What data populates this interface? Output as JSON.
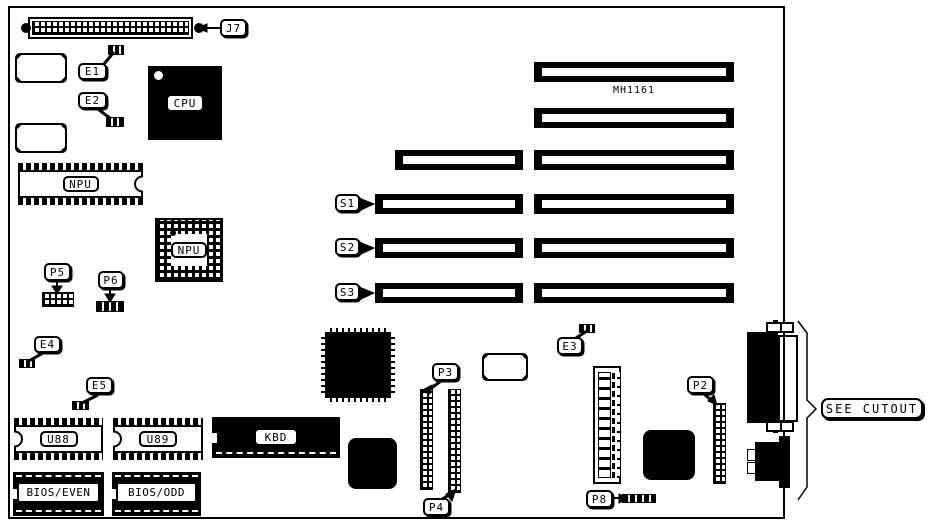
{
  "diagram": {
    "kind": "motherboard component layout",
    "board_text": {
      "mh1161": "MH1161"
    }
  },
  "callouts": {
    "j7": "J7",
    "e1": "E1",
    "e2": "E2",
    "e3": "E3",
    "e4": "E4",
    "e5": "E5",
    "p2": "P2",
    "p3": "P3",
    "p4": "P4",
    "p5": "P5",
    "p6": "P6",
    "p8": "P8",
    "s1": "S1",
    "s2": "S2",
    "s3": "S3",
    "see_cutout": "SEE CUTOUT"
  },
  "chips": {
    "cpu": "CPU",
    "npu_dip": "NPU",
    "npu_pga": "NPU",
    "u88": "U88",
    "u89": "U89",
    "kbd": "KBD",
    "bios_even": "BIOS/EVEN",
    "bios_odd": "BIOS/ODD"
  },
  "colors": {
    "ink": "#000000",
    "background": "#ffffff"
  }
}
